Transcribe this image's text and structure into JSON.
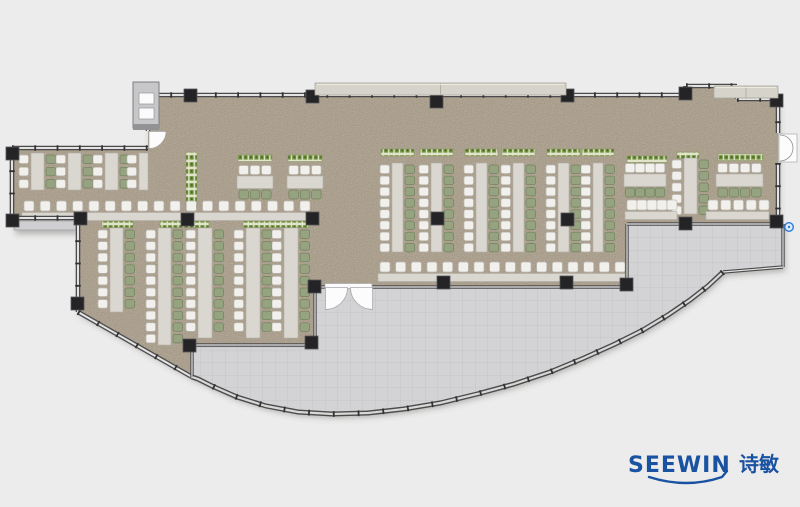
{
  "canvas": {
    "w": 800,
    "h": 507
  },
  "palette": {
    "bg": "#ececec",
    "floor": "#a69780",
    "floor_speckle": "#5e5244",
    "terrace": "#d3d3d5",
    "terrace_grid": "#c5c5c8",
    "wall": "#4b4b4d",
    "wall_core": "#e3e3e1",
    "wall_tick": "#333335",
    "column": "#242426",
    "table": "#dad7d0",
    "table_border": "#b2afa7",
    "chair_white": "#f2f0ed",
    "chair_white_border": "#bcb9b3",
    "chair_green": "#95a381",
    "chair_green_border": "#71805b",
    "planter_bg": "#e0e4cb",
    "planter_green": "#6c8c38",
    "planter_dot": "#38511c",
    "planter_border": "#8a9a63",
    "door": "#fcfcfc",
    "door_edge": "#a8a8aa",
    "shaft": "#c7c7c9",
    "shaft_edge": "#7e7e80",
    "band": "#d6d4ca",
    "band_edge": "#a9a79d",
    "ledge": "#cfcfd1",
    "logo_blue": "#1a52a2",
    "dot_blue": "#2e7cd6"
  },
  "logo": {
    "brand": "SEEWIN",
    "cn": "诗敏"
  },
  "plan": {
    "floor_polys": [
      [
        [
          148,
          95
        ],
        [
          686,
          95
        ],
        [
          686,
          86
        ],
        [
          737,
          86
        ],
        [
          737,
          99
        ],
        [
          778,
          99
        ],
        [
          778,
          224
        ],
        [
          627,
          224
        ],
        [
          627,
          287
        ],
        [
          315,
          287
        ],
        [
          315,
          218
        ],
        [
          148,
          218
        ]
      ],
      [
        [
          12,
          148
        ],
        [
          148,
          148
        ],
        [
          148,
          218
        ],
        [
          12,
          218
        ]
      ],
      [
        [
          78,
          218
        ],
        [
          315,
          218
        ],
        [
          315,
          347
        ],
        [
          192,
          347
        ],
        [
          192,
          377
        ],
        [
          78,
          312
        ]
      ]
    ],
    "terrace_poly": [
      [
        192,
        377
      ],
      [
        192,
        347
      ],
      [
        315,
        347
      ],
      [
        315,
        287
      ],
      [
        627,
        287
      ],
      [
        627,
        224
      ],
      [
        783,
        224
      ],
      [
        783,
        267
      ],
      [
        723,
        272
      ],
      [
        708,
        286
      ],
      [
        690,
        300
      ],
      [
        668,
        315
      ],
      [
        643,
        330
      ],
      [
        615,
        344
      ],
      [
        584,
        358
      ],
      [
        550,
        372
      ],
      [
        514,
        384
      ],
      [
        477,
        394
      ],
      [
        440,
        403
      ],
      [
        404,
        409
      ],
      [
        368,
        413
      ],
      [
        332,
        414
      ],
      [
        298,
        412
      ],
      [
        266,
        406
      ],
      [
        237,
        397
      ],
      [
        212,
        386
      ],
      [
        198,
        379
      ]
    ],
    "curve": [
      [
        723,
        272
      ],
      [
        708,
        286
      ],
      [
        690,
        300
      ],
      [
        668,
        315
      ],
      [
        643,
        330
      ],
      [
        615,
        344
      ],
      [
        584,
        358
      ],
      [
        550,
        372
      ],
      [
        514,
        384
      ],
      [
        477,
        394
      ],
      [
        440,
        403
      ],
      [
        404,
        409
      ],
      [
        368,
        413
      ],
      [
        332,
        414
      ],
      [
        298,
        412
      ],
      [
        266,
        406
      ],
      [
        237,
        397
      ],
      [
        212,
        386
      ],
      [
        198,
        379
      ],
      [
        192,
        377
      ]
    ],
    "walls_glass": [
      [
        12,
        148,
        148,
        148
      ],
      [
        12,
        148,
        12,
        218
      ],
      [
        12,
        218,
        78,
        218
      ],
      [
        78,
        218,
        78,
        312
      ],
      [
        78,
        312,
        192,
        377
      ],
      [
        148,
        95,
        148,
        131
      ],
      [
        148,
        95,
        686,
        95
      ],
      [
        686,
        86,
        686,
        95
      ],
      [
        686,
        86,
        737,
        86
      ],
      [
        737,
        86,
        737,
        99
      ],
      [
        737,
        99,
        778,
        99
      ],
      [
        778,
        99,
        778,
        133
      ],
      [
        778,
        163,
        778,
        224
      ]
    ],
    "walls_interior": [
      [
        315,
        287,
        325,
        287
      ],
      [
        372,
        287,
        627,
        287
      ],
      [
        627,
        224,
        627,
        287
      ],
      [
        627,
        224,
        783,
        224
      ],
      [
        783,
        224,
        783,
        267
      ],
      [
        723,
        272,
        783,
        267
      ],
      [
        192,
        345,
        315,
        345
      ],
      [
        315,
        289,
        315,
        345
      ],
      [
        192,
        345,
        192,
        377
      ]
    ],
    "columns": [
      [
        184,
        89
      ],
      [
        306,
        90
      ],
      [
        430,
        95
      ],
      [
        561,
        89
      ],
      [
        679,
        87
      ],
      [
        770,
        94
      ],
      [
        6,
        147
      ],
      [
        6,
        214
      ],
      [
        74,
        212
      ],
      [
        71,
        297
      ],
      [
        181,
        213
      ],
      [
        306,
        212
      ],
      [
        183,
        339
      ],
      [
        305,
        336
      ],
      [
        431,
        212
      ],
      [
        561,
        213
      ],
      [
        437,
        276
      ],
      [
        560,
        276
      ],
      [
        308,
        280
      ],
      [
        620,
        278
      ],
      [
        679,
        217
      ],
      [
        770,
        215
      ]
    ],
    "desk_units": [
      {
        "tx": 31,
        "ty": 153,
        "tb": 190,
        "tw": 13,
        "n": 3,
        "p": 12.3,
        "g": 1
      },
      {
        "tx": 68,
        "ty": 153,
        "tb": 190,
        "tw": 13,
        "n": 3,
        "p": 12.3,
        "g": 1
      },
      {
        "tx": 105,
        "ty": 153,
        "tb": 190,
        "tw": 13,
        "n": 3,
        "p": 12.3,
        "g": 1
      },
      {
        "tx": 139,
        "ty": 153,
        "tb": 190,
        "tw": 9,
        "n": 3,
        "p": 12.3,
        "g": 0
      },
      {
        "tx": 110,
        "ty": 228,
        "tb": 312,
        "tw": 13,
        "n": 7,
        "p": 11.6,
        "g": 1
      },
      {
        "tx": 158,
        "ty": 228,
        "tb": 345,
        "tw": 13,
        "n": 10,
        "p": 11.6,
        "g": 1
      },
      {
        "tx": 198,
        "ty": 228,
        "tb": 338,
        "tw": 14,
        "n": 9,
        "p": 11.6,
        "g": 1
      },
      {
        "tx": 246,
        "ty": 228,
        "tb": 338,
        "tw": 14,
        "n": 9,
        "p": 11.6,
        "g": 1
      },
      {
        "tx": 284,
        "ty": 228,
        "tb": 338,
        "tw": 14,
        "n": 9,
        "p": 11.6,
        "g": 1
      },
      {
        "tx": 392,
        "ty": 163,
        "tb": 252,
        "tw": 11,
        "n": 8,
        "p": 11.2,
        "g": 1,
        "pl": 1
      },
      {
        "tx": 431,
        "ty": 163,
        "tb": 252,
        "tw": 11,
        "n": 8,
        "p": 11.2,
        "g": 1,
        "pl": 1
      },
      {
        "tx": 476,
        "ty": 163,
        "tb": 252,
        "tw": 11,
        "n": 8,
        "p": 11.2,
        "g": 1,
        "pl": 1
      },
      {
        "tx": 513,
        "ty": 163,
        "tb": 252,
        "tw": 11,
        "n": 8,
        "p": 11.2,
        "g": 1,
        "pl": 1
      },
      {
        "tx": 558,
        "ty": 163,
        "tb": 252,
        "tw": 11,
        "n": 8,
        "p": 11.2,
        "g": 1,
        "pl": 1
      },
      {
        "tx": 593,
        "ty": 163,
        "tb": 252,
        "tw": 10,
        "n": 8,
        "p": 11.2,
        "g": 1,
        "pl": 1
      },
      {
        "tx": 684,
        "ty": 158,
        "tb": 214,
        "tw": 13,
        "n": 5,
        "p": 11.5,
        "g": 1
      }
    ],
    "desk_groups": [
      {
        "tx": 237,
        "ty": 176,
        "tw": 36,
        "th": 12.5,
        "nc": 3,
        "px": 238,
        "py": 155,
        "pw": 34
      },
      {
        "tx": 287,
        "ty": 176,
        "tw": 36,
        "th": 12.5,
        "nc": 3,
        "px": 288,
        "py": 155,
        "pw": 34
      },
      {
        "tx": 624,
        "ty": 174,
        "tw": 42,
        "th": 12.5,
        "nc": 4,
        "px": 627,
        "py": 156,
        "pw": 40
      },
      {
        "tx": 716,
        "ty": 174,
        "tw": 47,
        "th": 12.5,
        "nc": 4,
        "px": 718,
        "py": 154,
        "pw": 45
      }
    ],
    "bar_rows": [
      {
        "x1": 22,
        "x2": 310,
        "cy": 201,
        "ct": 212.5,
        "n": 18
      },
      {
        "x1": 378,
        "x2": 625,
        "cy": 262,
        "ct": 273.5,
        "n": 16
      },
      {
        "x1": 625,
        "x2": 677,
        "cy": 200,
        "ct": 211.5,
        "n": 5
      },
      {
        "x1": 706,
        "x2": 769,
        "cy": 200,
        "ct": 211.5,
        "n": 5
      }
    ],
    "planters_h": [
      [
        102,
        221,
        31
      ],
      [
        160,
        221,
        49
      ],
      [
        243,
        221,
        66
      ],
      [
        677,
        152,
        22
      ]
    ],
    "planter_v": [
      186,
      152,
      11,
      56
    ],
    "doors": {
      "entrance": {
        "x": 325,
        "w": 47,
        "y": 287
      },
      "left": {
        "x": 148,
        "y": 131
      },
      "right": {
        "x": 778,
        "y": 133
      }
    },
    "shaft": {
      "x": 133,
      "y": 82,
      "w": 26,
      "h": 46
    },
    "sill": [
      133,
      124,
      26,
      6
    ],
    "bands": [
      [
        315,
        83,
        251,
        12
      ],
      [
        714,
        86,
        64,
        12
      ]
    ],
    "ledges": [
      [
        14,
        221,
        62,
        9
      ]
    ],
    "blue_dot": {
      "cx": 789,
      "cy": 227
    }
  }
}
